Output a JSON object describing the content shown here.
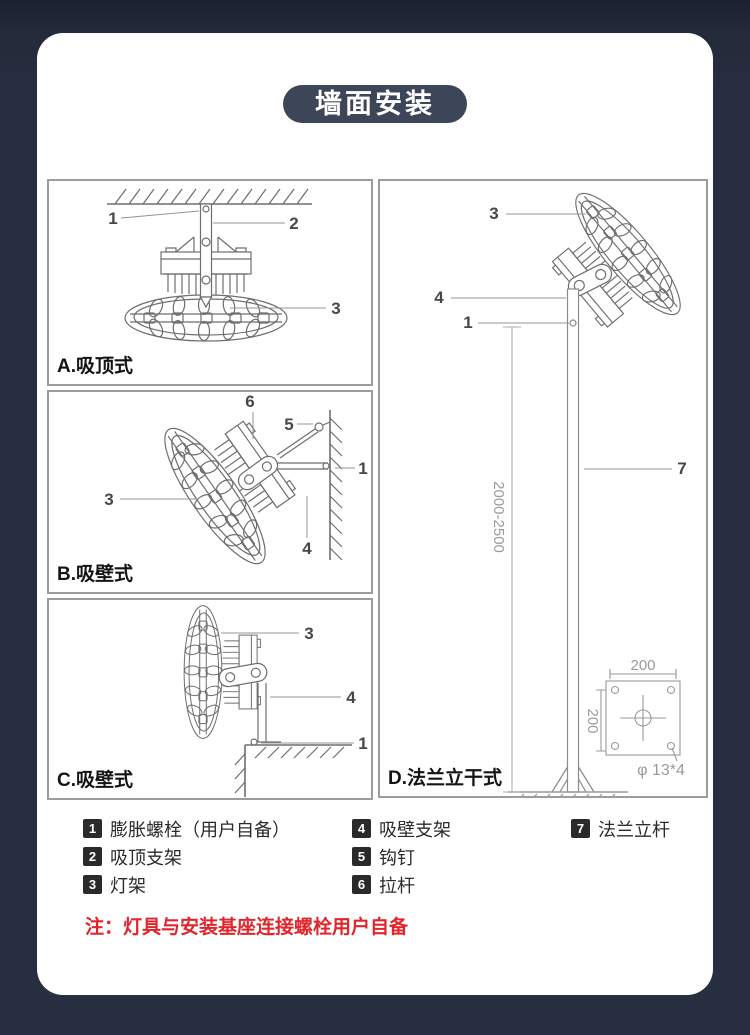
{
  "header": {
    "title": "墙面安装"
  },
  "panels": [
    {
      "id": "A",
      "label": "A.吸顶式",
      "callouts": [
        "1",
        "2",
        "3"
      ]
    },
    {
      "id": "B",
      "label": "B.吸壁式",
      "callouts": [
        "6",
        "5",
        "1",
        "3",
        "4"
      ]
    },
    {
      "id": "C",
      "label": "C.吸壁式",
      "callouts": [
        "3",
        "4",
        "1"
      ]
    },
    {
      "id": "D",
      "label": "D.法兰立干式",
      "callouts": [
        "3",
        "4",
        "1",
        "7"
      ],
      "dimensions": {
        "pole_height": "2000-2500",
        "flange_width": "200",
        "flange_height": "200",
        "bolt_holes": "φ 13*4"
      }
    }
  ],
  "legend": {
    "items": [
      {
        "num": "1",
        "label": "膨胀螺栓（用户自备）"
      },
      {
        "num": "2",
        "label": "吸顶支架"
      },
      {
        "num": "3",
        "label": "灯架"
      },
      {
        "num": "4",
        "label": "吸壁支架"
      },
      {
        "num": "5",
        "label": "钩钉"
      },
      {
        "num": "6",
        "label": "拉杆"
      },
      {
        "num": "7",
        "label": "法兰立杆"
      }
    ]
  },
  "note": {
    "text": "注：灯具与安装基座连接螺栓用户自备"
  },
  "colors": {
    "background": "#272e40",
    "badge": "#3d4659",
    "note": "#e0262d"
  }
}
